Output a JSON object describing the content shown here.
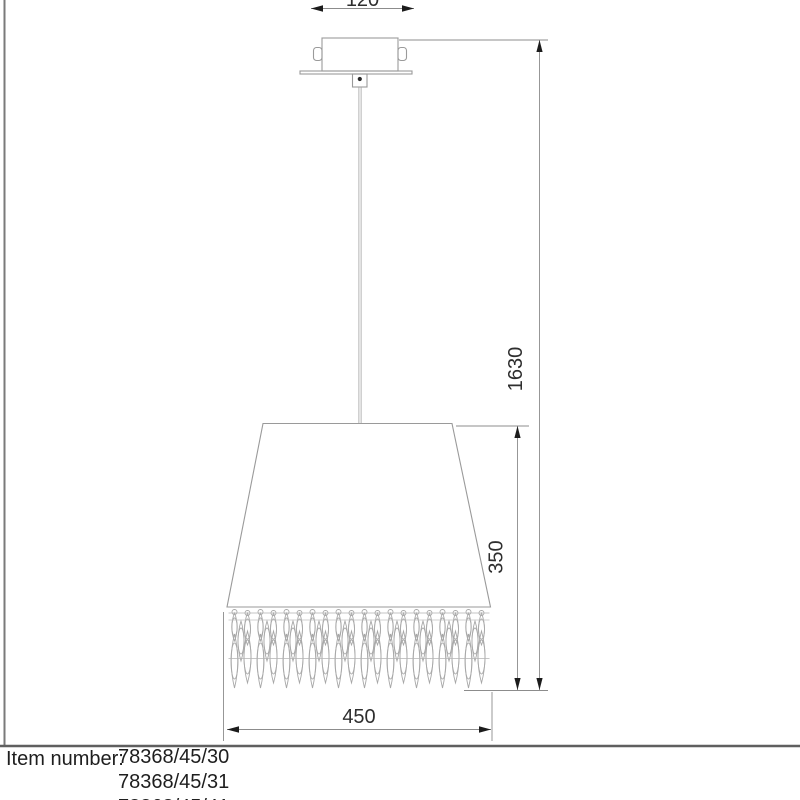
{
  "drawing": {
    "title": "pendant-lamp-dimension-drawing",
    "dimensions": {
      "canopy_width_mm": "120",
      "total_height_mm": "1630",
      "shade_height_mm": "350",
      "shade_width_mm": "450"
    },
    "item_block": {
      "label": "Item number:",
      "items": [
        "78368/45/30",
        "78368/45/31",
        "78368/45/41"
      ]
    },
    "colors": {
      "outline": "#9a9a9a",
      "dimension_line": "#8c8c8c",
      "arrow": "#1c1c1c",
      "text": "#1e1e1e",
      "fringe": "#a8a8a8",
      "frame": "#6f6f6f"
    }
  }
}
